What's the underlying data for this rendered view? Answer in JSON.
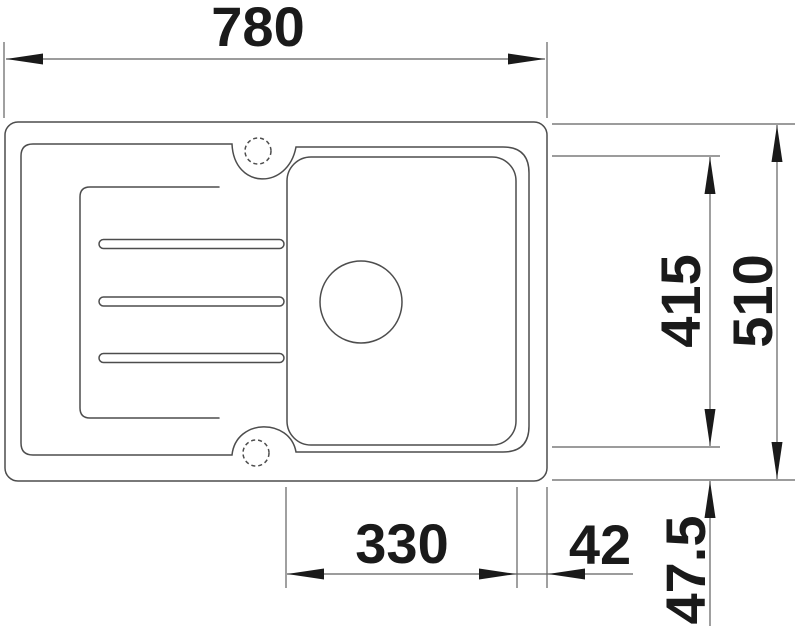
{
  "drawing": {
    "kind": "sink-technical-top-view",
    "labels": {
      "overall_width": "780",
      "overall_depth": "510",
      "bowl_depth": "415",
      "bowl_width": "330",
      "bowl_right_offset": "42",
      "bowl_bottom_offset": "47.5"
    },
    "colors": {
      "background": "#ffffff",
      "outline": "#4d4d4d",
      "dimension_line": "#606060",
      "dimension_text": "#1a1a1a",
      "arrow": "#1a1a1a"
    }
  }
}
